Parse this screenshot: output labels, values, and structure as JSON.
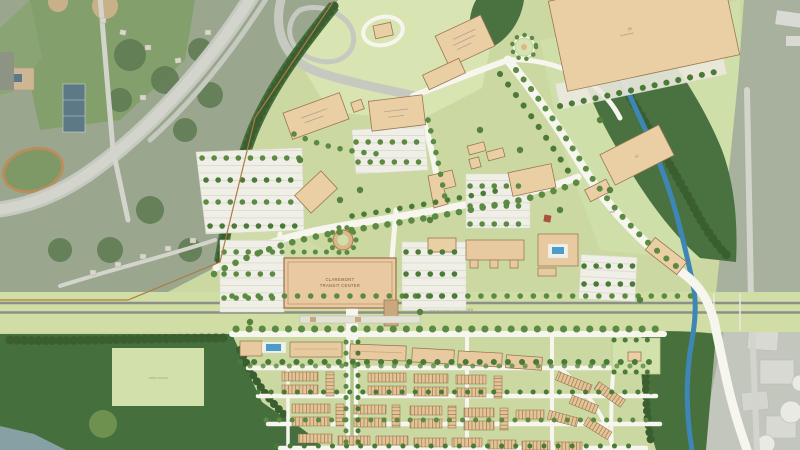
{
  "map": {
    "type": "site-master-plan-over-aerial-photo",
    "labels": {
      "transit_center_line1": "CLAREMONT",
      "transit_center_line2": "TRANSIT CENTER",
      "rail_corridor": "EXISTING  RAIL ROAD",
      "open_field": "OPEN SPACE",
      "building_2b": "2B",
      "building_6c": "6C",
      "parcel_45a": "45A",
      "parcel_45b": "45B"
    },
    "colors": {
      "plan_grass": "#cbd8a2",
      "lawn_light": "#d8e4b2",
      "forest_green": "#4a7240",
      "street_tree_green": "#5c8a42",
      "building_tan": "#ebcfa4",
      "townhouse_tan": "#e4c496",
      "road_white": "#f6f6ef",
      "rail_gray": "#8d9086",
      "creek_blue": "#3e86b6",
      "pool_blue": "#4b9cc9",
      "aerial_gray_green": "#9aa78e",
      "industrial_gray": "#c3c6bd",
      "boundary_brown": "#ad7c42"
    },
    "features": [
      "aerial-school-campus-with-track-and-courts",
      "highway-interchange",
      "rail-corridor-band",
      "claremont-transit-center-building",
      "big-box-retail-building",
      "office-and-mixed-use-buildings",
      "surface-parking-lots-with-tree-rows",
      "roundabout-plaza",
      "creek-greenway-forest",
      "residential-townhouse-blocks",
      "apartment-buildings-with-pools",
      "open-space-field",
      "industrial-area-with-storage-tanks"
    ]
  }
}
